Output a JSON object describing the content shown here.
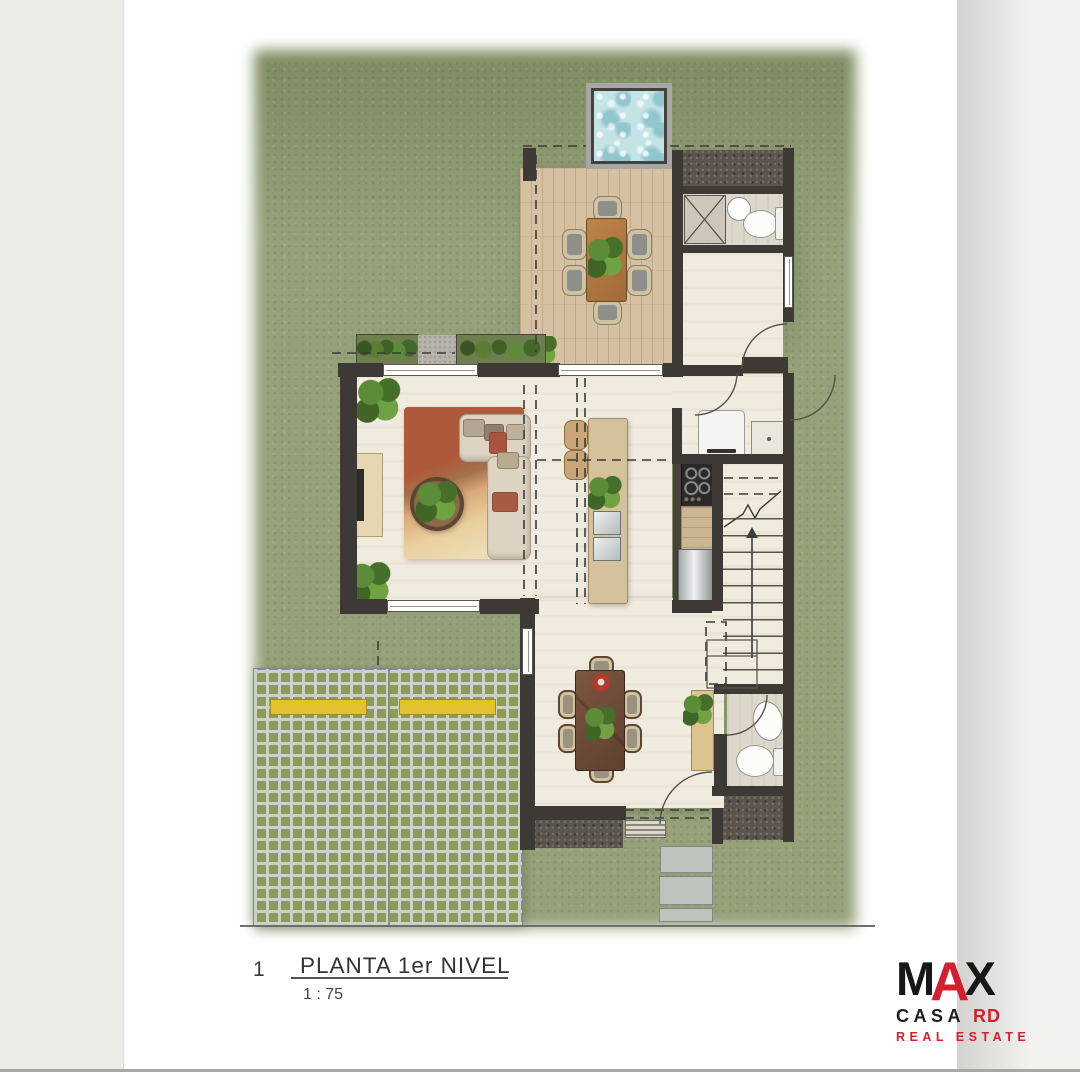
{
  "title_block": {
    "sheet_number": "1",
    "drawing_title": "PLANTA 1er NIVEL",
    "scale": "1 : 75"
  },
  "logo": {
    "main_m": "M",
    "main_a": "A",
    "main_x": "X",
    "sub_word": "CASA",
    "sub_suffix": "RD",
    "tagline": "REAL ESTATE",
    "color_red": "#d4202e",
    "color_black": "#171717"
  },
  "palette": {
    "grass": "#96a17a",
    "wall": "#3d3a36",
    "interior_floor": "#f0ebdf",
    "bath_floor": "#ddd8cb",
    "deck_wood": "#d5c1a1",
    "pool_water": "#c4e3e5",
    "paver_green": "#8c9b55",
    "paver_gap": "#cbd1c9",
    "parking_stop_yellow": "#e2c22d",
    "gravel": "#5b544d",
    "rug_terracotta": "#ae5a3a",
    "dining_table_wood": "#5e4130",
    "terrace_table_wood": "#b07a42"
  }
}
